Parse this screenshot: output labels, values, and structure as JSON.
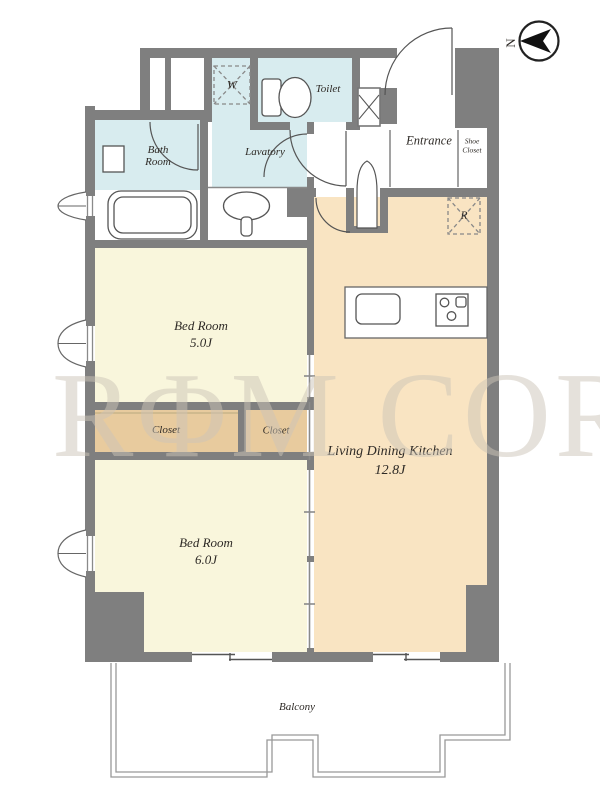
{
  "plan": {
    "title": "apartment floor plan",
    "compass": {
      "label": "N"
    },
    "watermark": "RΦM CORE",
    "rooms": {
      "bath": {
        "name": "Bath Room"
      },
      "lavatory": {
        "name": "Lavatory"
      },
      "toilet": {
        "name": "Toilet"
      },
      "entrance": {
        "name": "Entrance"
      },
      "shoe_closet": {
        "line1": "Shoe",
        "line2": "Closet"
      },
      "bedroom1": {
        "name": "Bed Room",
        "size": "5.0J"
      },
      "bedroom2": {
        "name": "Bed Room",
        "size": "6.0J"
      },
      "ldk": {
        "name": "Living Dining Kitchen",
        "size": "12.8J"
      },
      "closet1": {
        "name": "Closet"
      },
      "closet2": {
        "name": "Closet"
      },
      "balcony": {
        "name": "Balcony"
      }
    },
    "fixtures": {
      "washer_label": "W",
      "fridge_label": "R"
    },
    "colors": {
      "wall": "#7f7f7f",
      "wet_room": "#d8ecef",
      "bedroom": "#f9f6dc",
      "ldk": "#f9e4c2",
      "closet": "#e8cb9e",
      "line": "#555555",
      "balcony_line": "#999999",
      "watermark": "#cdc5b8"
    }
  }
}
